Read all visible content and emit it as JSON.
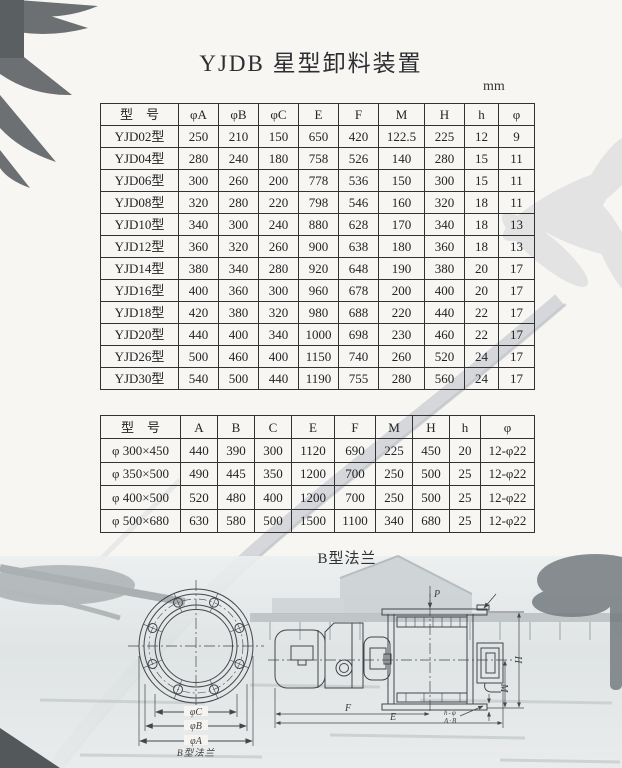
{
  "page": {
    "title": "YJDB 星型卸料装置",
    "unit_label": "mm",
    "section2_title": "B型法兰"
  },
  "table1": {
    "headers": [
      "型　号",
      "φA",
      "φB",
      "φC",
      "E",
      "F",
      "M",
      "H",
      "h",
      "φ"
    ],
    "rows": [
      [
        "YJD02型",
        "250",
        "210",
        "150",
        "650",
        "420",
        "122.5",
        "225",
        "12",
        "9"
      ],
      [
        "YJD04型",
        "280",
        "240",
        "180",
        "758",
        "526",
        "140",
        "280",
        "15",
        "11"
      ],
      [
        "YJD06型",
        "300",
        "260",
        "200",
        "778",
        "536",
        "150",
        "300",
        "15",
        "11"
      ],
      [
        "YJD08型",
        "320",
        "280",
        "220",
        "798",
        "546",
        "160",
        "320",
        "18",
        "11"
      ],
      [
        "YJD10型",
        "340",
        "300",
        "240",
        "880",
        "628",
        "170",
        "340",
        "18",
        "13"
      ],
      [
        "YJD12型",
        "360",
        "320",
        "260",
        "900",
        "638",
        "180",
        "360",
        "18",
        "13"
      ],
      [
        "YJD14型",
        "380",
        "340",
        "280",
        "920",
        "648",
        "190",
        "380",
        "20",
        "17"
      ],
      [
        "YJD16型",
        "400",
        "360",
        "300",
        "960",
        "678",
        "200",
        "400",
        "20",
        "17"
      ],
      [
        "YJD18型",
        "420",
        "380",
        "320",
        "980",
        "688",
        "220",
        "440",
        "22",
        "17"
      ],
      [
        "YJD20型",
        "440",
        "400",
        "340",
        "1000",
        "698",
        "230",
        "460",
        "22",
        "17"
      ],
      [
        "YJD26型",
        "500",
        "460",
        "400",
        "1150",
        "740",
        "260",
        "520",
        "24",
        "17"
      ],
      [
        "YJD30型",
        "540",
        "500",
        "440",
        "1190",
        "755",
        "280",
        "560",
        "24",
        "17"
      ]
    ]
  },
  "table2": {
    "headers": [
      "型　号",
      "A",
      "B",
      "C",
      "E",
      "F",
      "M",
      "H",
      "h",
      "φ"
    ],
    "rows": [
      [
        "φ 300×450",
        "440",
        "390",
        "300",
        "1120",
        "690",
        "225",
        "450",
        "20",
        "12-φ22"
      ],
      [
        "φ 350×500",
        "490",
        "445",
        "350",
        "1200",
        "700",
        "250",
        "500",
        "25",
        "12-φ22"
      ],
      [
        "φ 400×500",
        "520",
        "480",
        "400",
        "1200",
        "700",
        "250",
        "500",
        "25",
        "12-φ22"
      ],
      [
        "φ 500×680",
        "630",
        "580",
        "500",
        "1500",
        "1100",
        "340",
        "680",
        "25",
        "12-φ22"
      ]
    ]
  },
  "drawing": {
    "flange": {
      "caption": "B型法兰",
      "dims": [
        "φC",
        "φB",
        "φA"
      ]
    },
    "side": {
      "p": "P",
      "h": "H",
      "m": "M",
      "f": "F",
      "e": "E",
      "callout_line1": "h-φ",
      "callout_line2": "A·B"
    }
  }
}
